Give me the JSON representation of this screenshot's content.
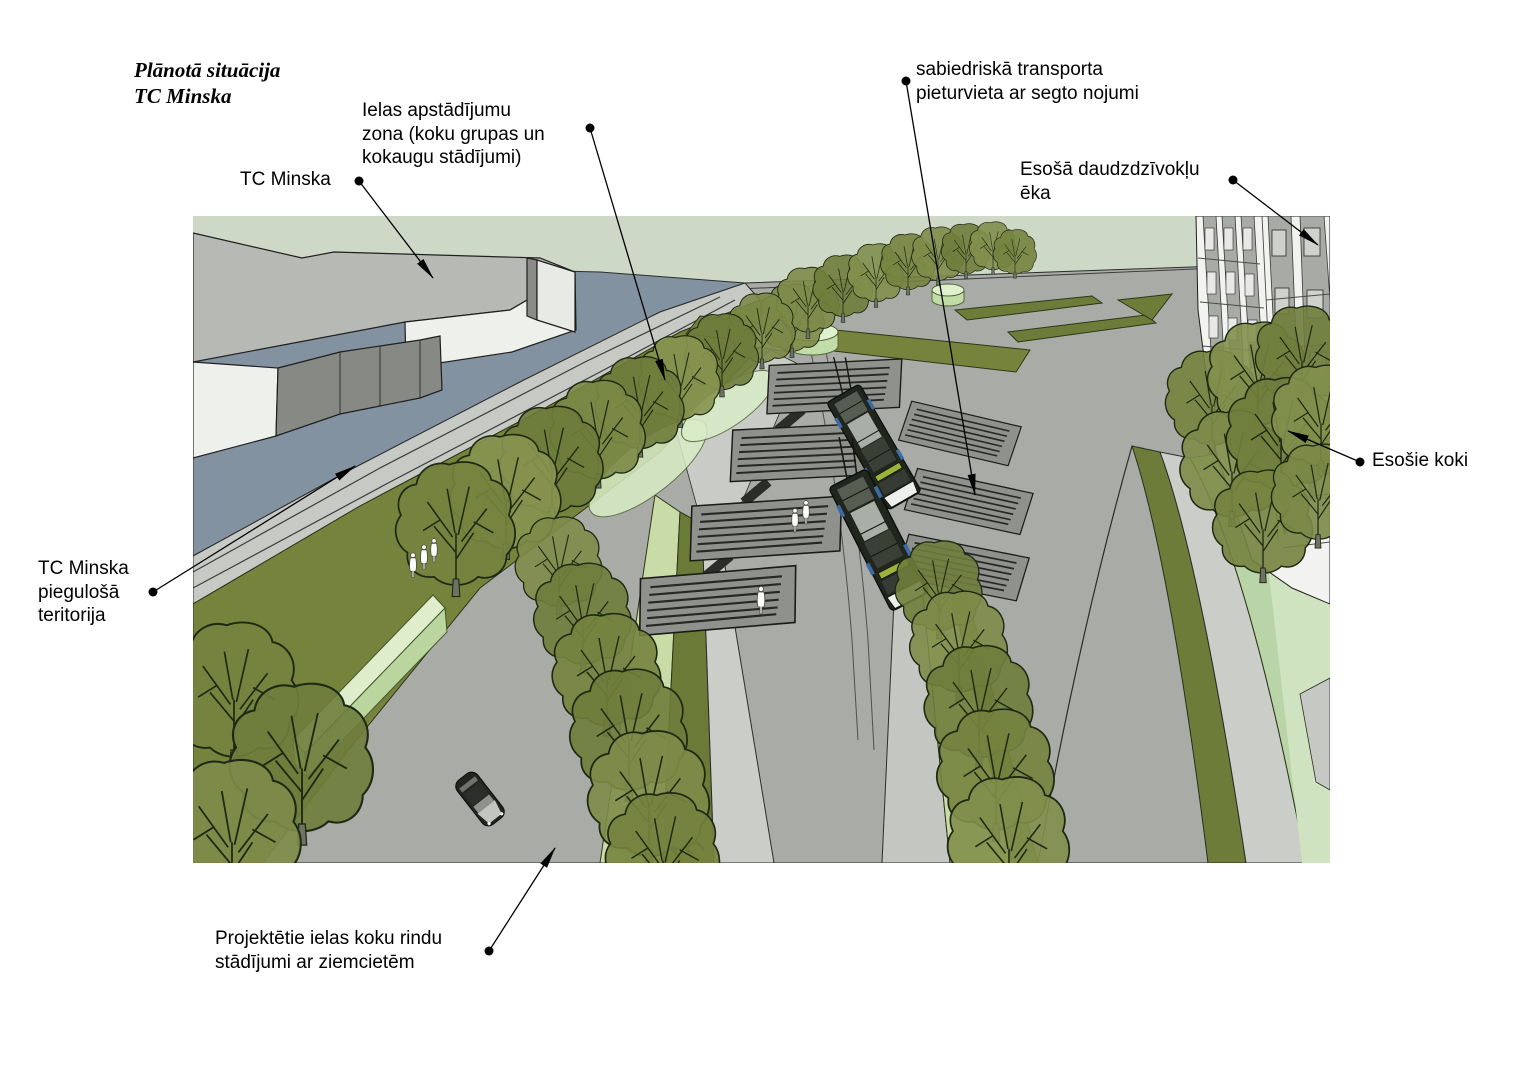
{
  "figure": {
    "kind": "3d-site-plan-visualization",
    "subject": "Planned street landscaping situation at TC Minska with public transport stop"
  },
  "title": {
    "line1": "Plānotā situācija",
    "line2": "TC Minska"
  },
  "annotations": {
    "tc_minska": {
      "text": "TC Minska"
    },
    "ielas_apstadijumu": {
      "text": "Ielas apstādījumu\nzona (koku grupas un\nkokaugu stādījumi)"
    },
    "sabiedriska_transporta": {
      "text": "sabiedriskā transporta\npieturvieta ar segto nojumi"
    },
    "esosa_eka": {
      "text": "Esošā daudzdzīvokļu\nēka"
    },
    "esosie_koki": {
      "text": "Esošie koki"
    },
    "piegulosa_teritorija": {
      "text": "TC Minska\npiegulošā\nteritorija"
    },
    "projektetie_stadijumi": {
      "text": "Projektētie ielas koku rindu\nstādījumi ar ziemcietēm"
    }
  },
  "colors": {
    "page_background": "#ffffff",
    "terrain_green": "#cdd8c6",
    "territory_blue_gray": "#8392a1",
    "road_gray": "#a9aba7",
    "sidewalk_gray": "#c9cbc7",
    "verge_olive": "#75833d",
    "tree_olive": "#7b8847",
    "underplanting_light": "#c9dba6",
    "lawn_light_green": "#b9d4a6",
    "planter_light_green": "#dff0cc",
    "building_white": "#f2f3f0",
    "roof_gray": "#b7b9b5",
    "shelter_gray": "#8f918d",
    "annotation_black": "#000000"
  }
}
